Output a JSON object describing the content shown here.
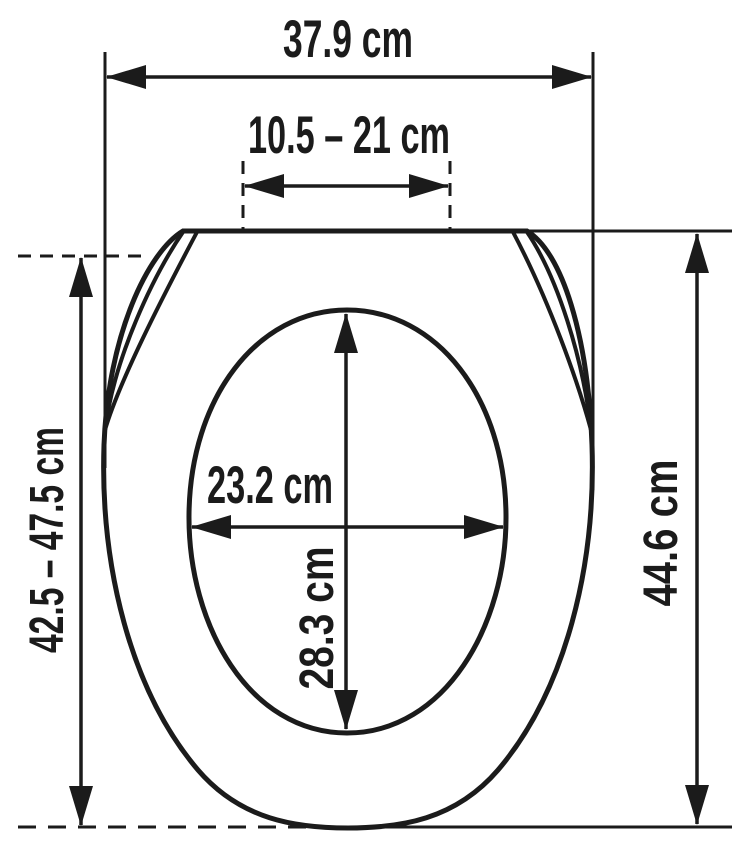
{
  "diagram": {
    "type": "technical-dimension-drawing",
    "labels": {
      "overall_width": "37.9 cm",
      "hinge_distance_range": "10.5 – 21 cm",
      "inner_width": "23.2 cm",
      "inner_depth": "28.3 cm",
      "overall_depth_range": "42.5 – 47.5 cm",
      "seat_depth": "44.6 cm"
    },
    "colors": {
      "ink": "#1b1b1b",
      "background": "#ffffff"
    }
  }
}
